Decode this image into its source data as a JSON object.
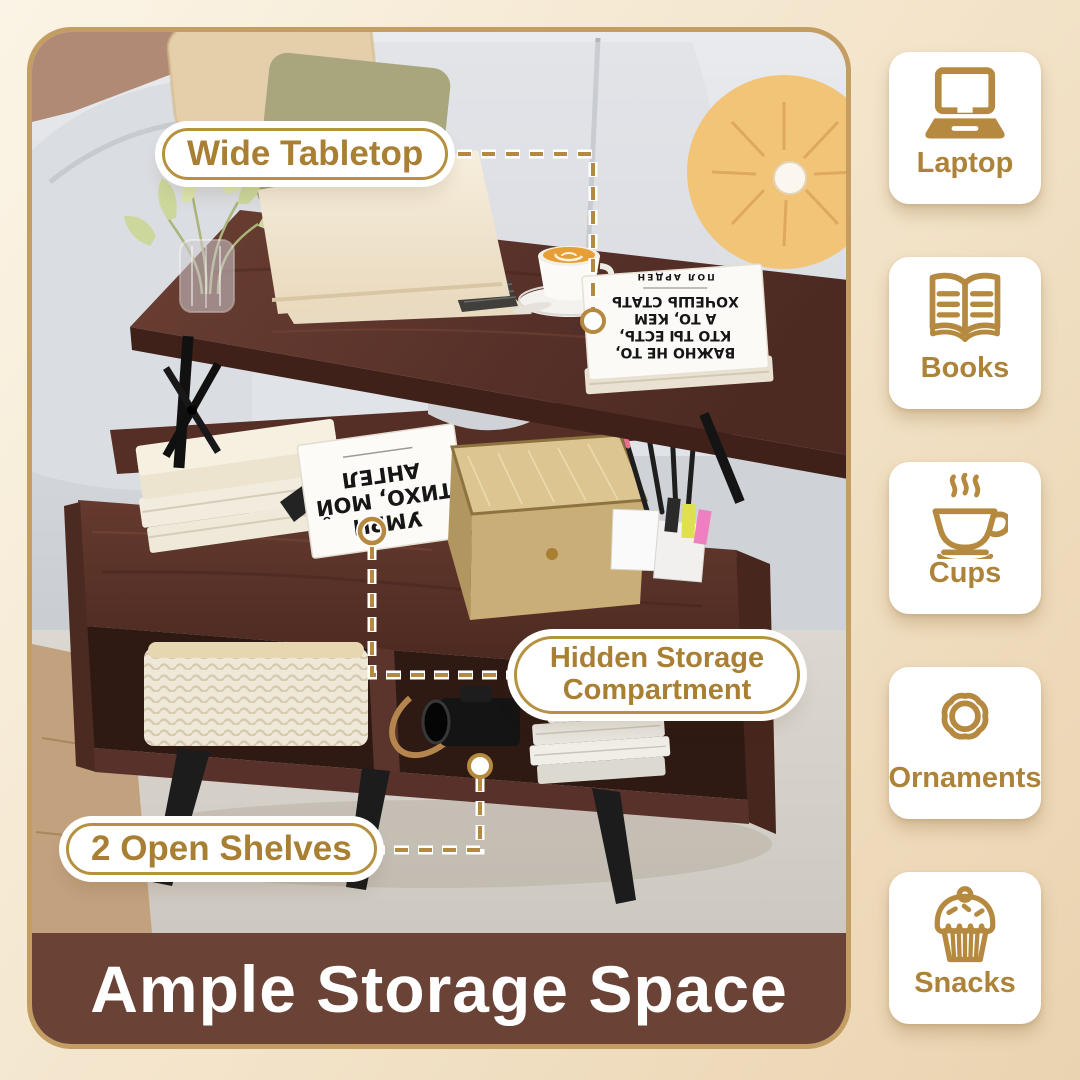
{
  "banner": {
    "title": "Ample Storage Space"
  },
  "callouts": {
    "wide_tabletop": "Wide Tabletop",
    "hidden_storage_line1": "Hidden Storage",
    "hidden_storage_line2": "Compartment",
    "open_shelves": "2 Open Shelves"
  },
  "sidebar": {
    "items": [
      {
        "icon": "laptop-icon",
        "label": "Laptop"
      },
      {
        "icon": "book-icon",
        "label": "Books"
      },
      {
        "icon": "cup-icon",
        "label": "Cups"
      },
      {
        "icon": "ornament-icon",
        "label": "Ornaments"
      },
      {
        "icon": "cupcake-icon",
        "label": "Snacks"
      }
    ]
  },
  "photo_books": {
    "tabletop_book": {
      "lines": [
        "ВАЖНО НЕ ТО,",
        "КТО ТЫ ЕСТЬ,",
        "А ТО, КЕМ",
        "ХОЧЕШЬ СТАТЬ"
      ],
      "author": "ПОЛ АРДЕН"
    },
    "compartment_book": {
      "lines": [
        "УМРИ",
        "ТИХО, МОЙ",
        "АНГЕЛ"
      ]
    }
  },
  "colors": {
    "accent_gold": "#b5893f",
    "banner_brown": "#6a4336",
    "label_text": "#a87f33",
    "frame_border": "#c39d62"
  }
}
